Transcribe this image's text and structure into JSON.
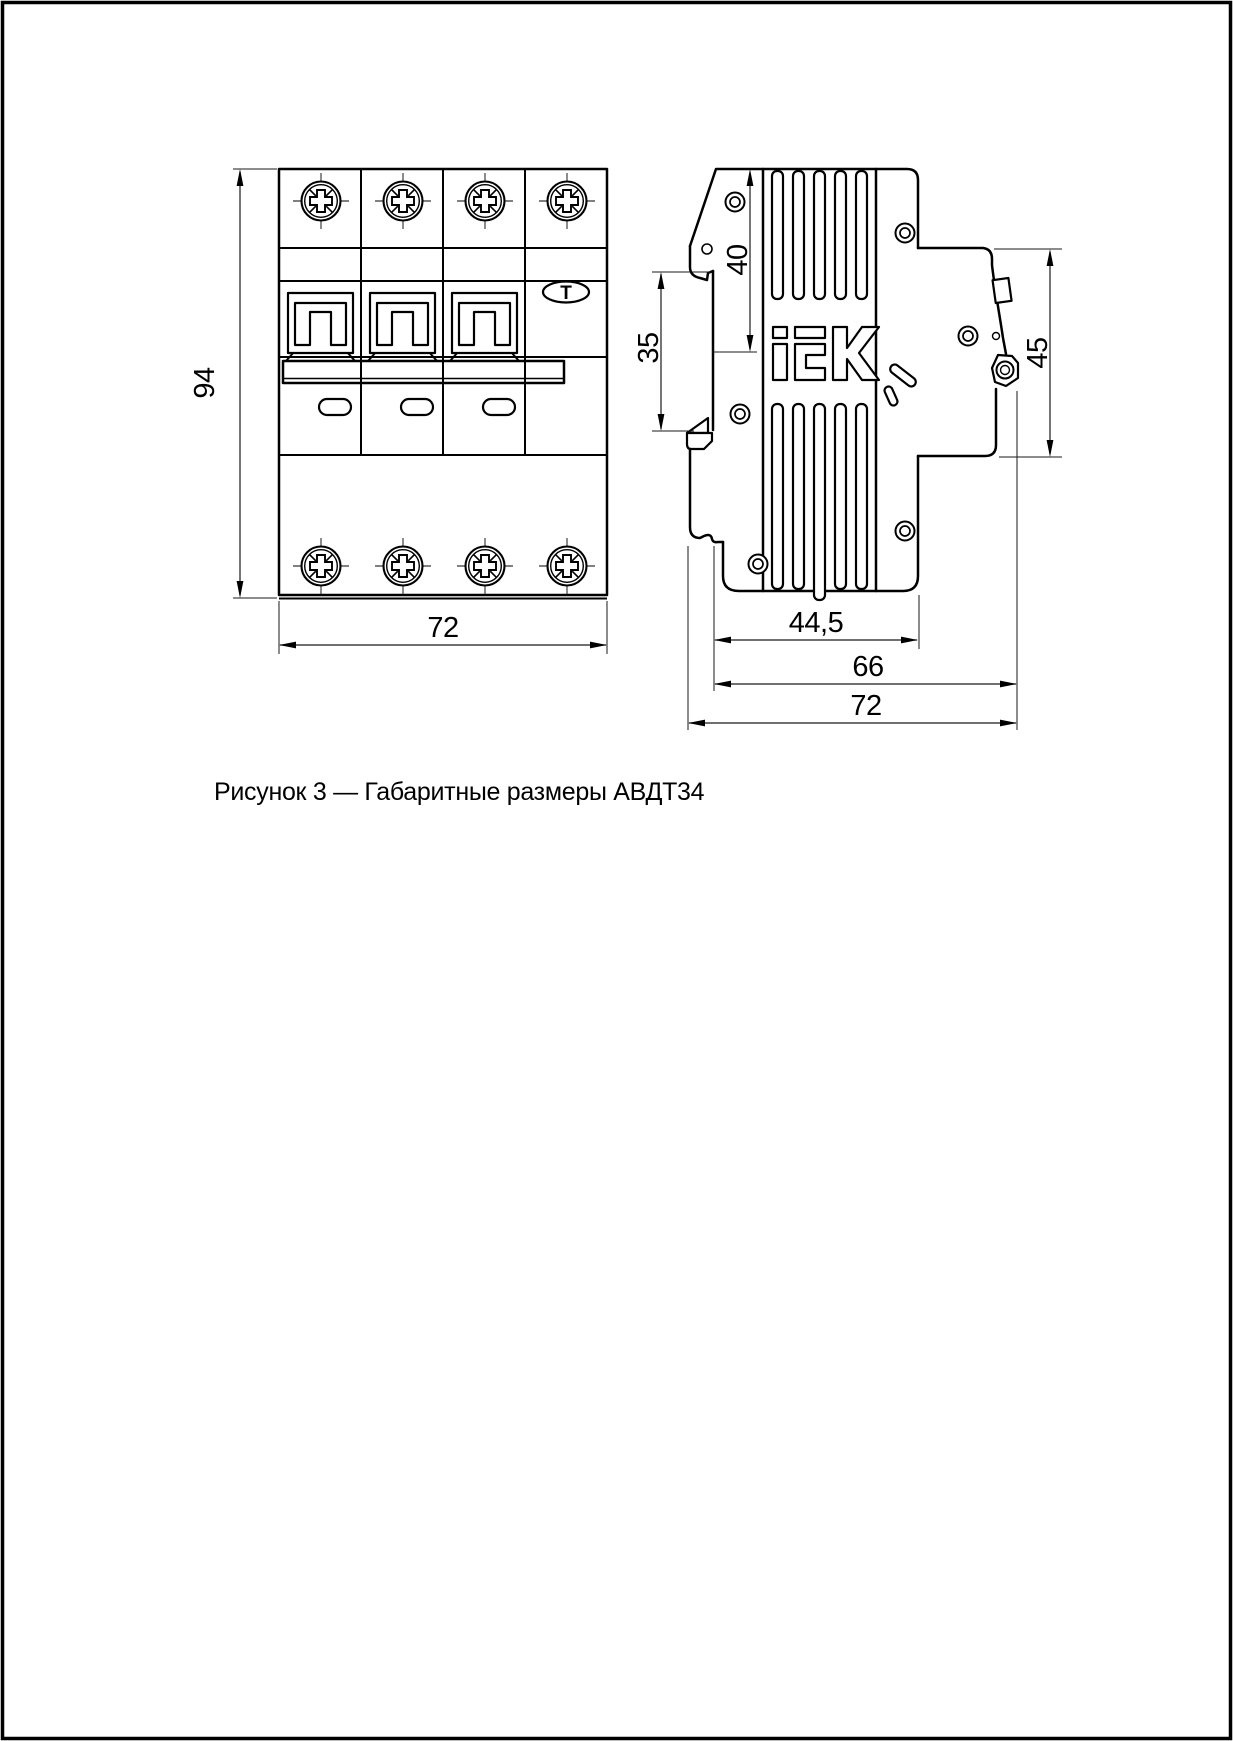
{
  "page": {
    "caption": "Рисунок 3 — Габаритные размеры АВДТ34"
  },
  "front_view": {
    "height": "94",
    "width": "72",
    "test_button": "T"
  },
  "side_view": {
    "logo": "IEK",
    "dims": {
      "top_to_din": "40",
      "din_height": "35",
      "front_height": "45",
      "body_depth": "44,5",
      "depth_to_terminal": "66",
      "total_depth": "72"
    }
  },
  "colors": {
    "line": "#000000",
    "background": "#ffffff"
  }
}
